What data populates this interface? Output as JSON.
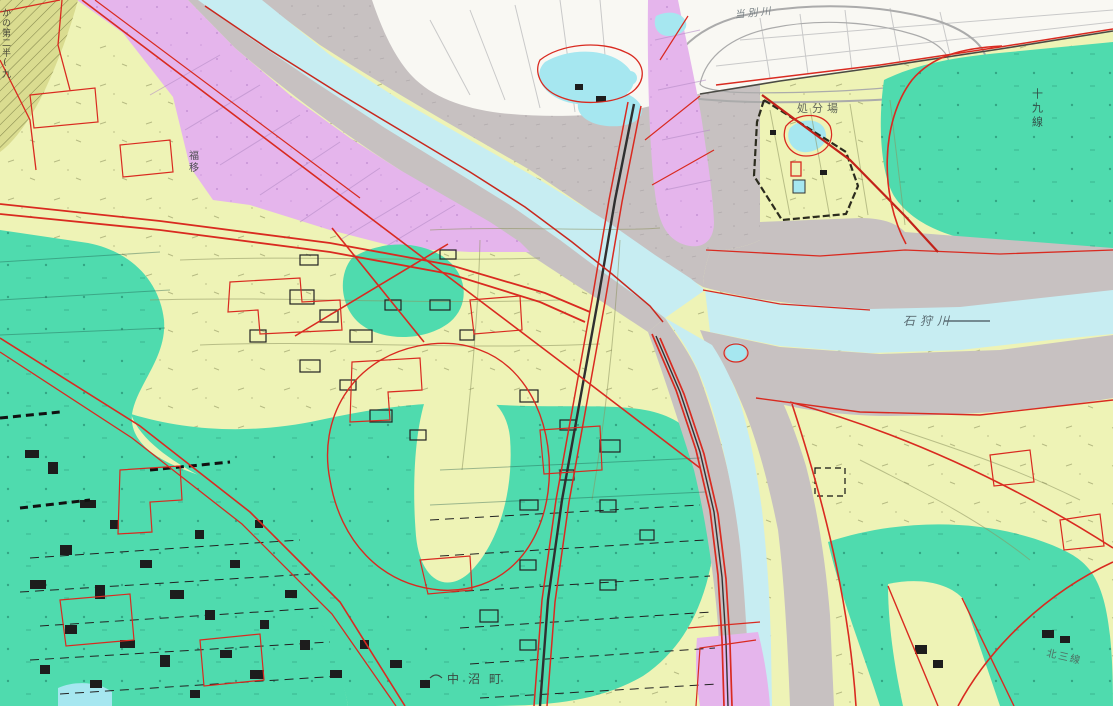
{
  "labels": {
    "ishikari_river": "石狩川",
    "tobetsu_river": "当別川",
    "disposal_site": "処分場",
    "line_19": "十九線",
    "kita_3_line": "北三線",
    "nakanuma_cho": "中沼町",
    "fukui": "福移",
    "edge_text": "かの第二半(九"
  },
  "palette": {
    "farmland_yellow": "#EEF3B6",
    "wetland_teal": "#4FDBAE",
    "floodplain_pink": "#E5B5EC",
    "bare_gray": "#C7C1C1",
    "river_blue": "#C7EDF2",
    "pond_cyan": "#A6E7F0",
    "built_white": "#F9F8F3",
    "boundary_red": "#D92A20",
    "main_red": "#C2221A",
    "ink_black": "#1D1D1D",
    "olive_hatch": "#DADC90"
  }
}
